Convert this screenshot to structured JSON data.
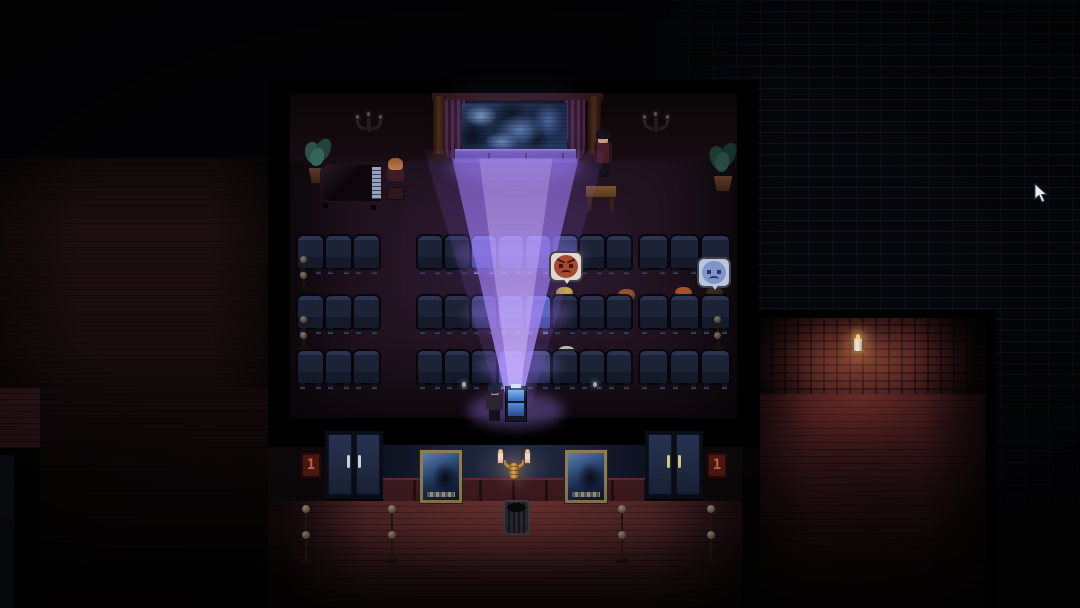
{
  "scene": {
    "type": "top-down pixel-art game — movie theater",
    "palette": {
      "background": "#04060a",
      "beam_purple": "#9a7ce6",
      "screen_blue": "#2c3f66",
      "theater_floor": "#221320",
      "seat_navy": "#1d2336",
      "seat_lit_blue": "#3f62ac",
      "lobby_floor_red": "#4c2327",
      "brick_red": "#4a1d21",
      "curtain_maroon": "#4d2340",
      "gold": "#b08136"
    },
    "theater": {
      "seat_rows": [
        {
          "y": 236,
          "lit": {
            "1": {
              "2": "l",
              "3": "l",
              "4": "l",
              "5": "d"
            }
          }
        },
        {
          "y": 296,
          "lit": {
            "1": {
              "2": "d",
              "3": "l",
              "4": "l"
            }
          }
        },
        {
          "y": 351,
          "lit": {
            "1": {
              "3": "l",
              "4": "d"
            }
          }
        }
      ],
      "seat_groups": [
        {
          "x": 298,
          "count": 3,
          "pitch": 28,
          "w": 25
        },
        {
          "x": 418,
          "count": 8,
          "pitch": 27,
          "w": 24
        },
        {
          "x": 640,
          "count": 3,
          "pitch": 31,
          "w": 27
        }
      ],
      "audience": [
        {
          "x": 556,
          "y": 287,
          "hair": "#c3a355",
          "label": "blonde-viewer"
        },
        {
          "x": 618,
          "y": 289,
          "hair": "#92522c",
          "label": "brown-haired-viewer"
        },
        {
          "x": 675,
          "y": 287,
          "hair": "#a0552e",
          "label": "auburn-viewer"
        },
        {
          "x": 706,
          "y": 287,
          "hair": "#39291f",
          "label": "dark-haired-viewer"
        },
        {
          "x": 558,
          "y": 346,
          "hair": "#b7b5ac",
          "label": "white-haired-viewer"
        },
        {
          "x": 585,
          "y": 349,
          "hair": "#6f451f",
          "label": "hat-viewer"
        }
      ],
      "emotes": [
        {
          "x": 549,
          "y": 251,
          "type": "angry",
          "shell": "#ded8d0",
          "face": "#a34a30",
          "features": "#43150b"
        },
        {
          "x": 697,
          "y": 257,
          "type": "sad",
          "shell": "#b9c6dd",
          "face": "#8095c8",
          "features": "#25356b"
        }
      ],
      "candle_stands": [
        {
          "x": 299,
          "y": 256
        },
        {
          "x": 299,
          "y": 316
        },
        {
          "x": 713,
          "y": 316
        }
      ],
      "booth_lights": [
        462,
        593
      ]
    },
    "lobby": {
      "signs": [
        {
          "label": "1"
        },
        {
          "label": "1"
        }
      ],
      "doors": [
        {
          "handle_color": "#ccd2da"
        },
        {
          "handle_color": "#d6c87e"
        }
      ],
      "stanchions": [
        {
          "x": 301,
          "y": 505
        },
        {
          "x": 387,
          "y": 505
        },
        {
          "x": 617,
          "y": 505
        },
        {
          "x": 706,
          "y": 505
        }
      ]
    }
  }
}
